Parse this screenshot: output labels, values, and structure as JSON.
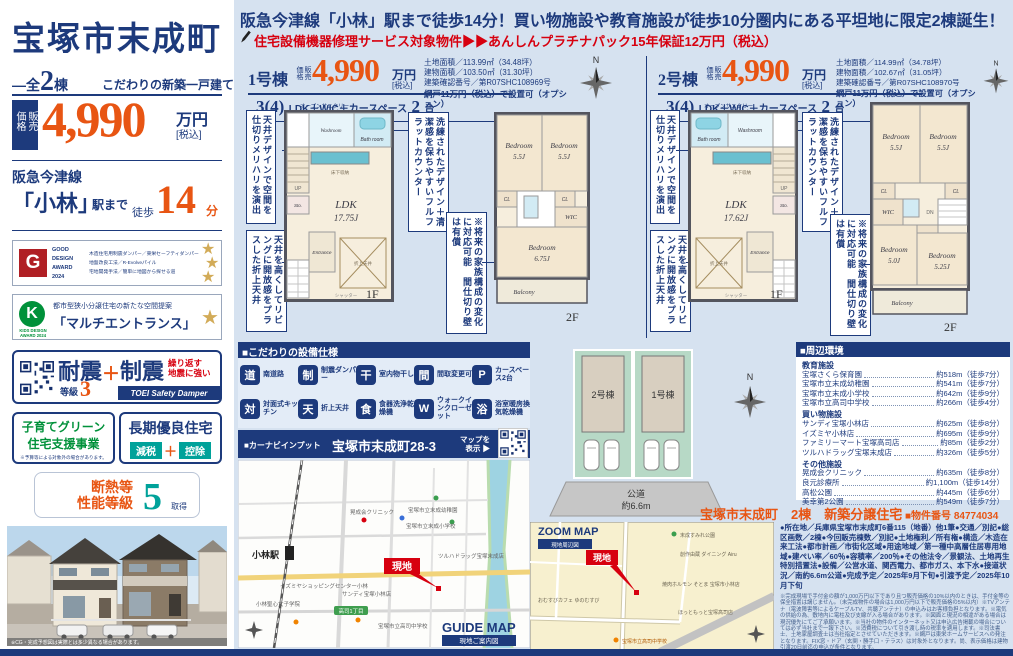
{
  "meta": {
    "compass_n": "N"
  },
  "sidebar": {
    "title": "宝塚市末成町",
    "units_dash": "—",
    "units_prefix": "全",
    "units_num": "2",
    "units_suffix": "棟",
    "tagline": "こだわりの新築一戸建て",
    "price_tag": "販売価格",
    "price": "4,990",
    "price_unit": "万円",
    "price_tax": "[税込]",
    "line_name": "阪急今津線",
    "station": "「小林」",
    "station_suffix": "駅まで",
    "walk_label": "徒歩",
    "walk_num": "14",
    "walk_unit": "分",
    "good_design": {
      "label1": "GOOD",
      "label2": "DESIGN",
      "label3": "AWARD",
      "label4": "2024",
      "desc1": "木造住宅用制震ダンパー／東栄セーフティダンパー",
      "desc2": "地盤改良工法／R-Evolveパイル",
      "desc3": "宅地開発手法／簡単に地図から探せる道"
    },
    "kids_design": {
      "label1": "KIDS DESIGN",
      "label2": "AWARD 2024",
      "desc": "都市型狭小分譲住宅の新たな空間提案",
      "name": "「マルチエントランス」"
    },
    "taishin": {
      "t1": "耐震",
      "grade_label": "等級",
      "grade_num": "3",
      "plus": "＋",
      "t2": "制震",
      "note1": "繰り返す",
      "note2": "地震に強い",
      "brand": "TOEI Safety Damper"
    },
    "kosodate": {
      "l1": "子育てグリーン",
      "l2": "住宅支援事業",
      "note": "※予算等による対象外の場合があります。"
    },
    "chouki": {
      "title": "長期優良住宅",
      "tag1": "減税",
      "plus": "＋",
      "tag2": "控除"
    },
    "dannetsu": {
      "l1": "断熱等",
      "l2": "性能等級",
      "num": "5",
      "suffix": "取得"
    },
    "photo_caption": "※CG・完成予想図は実際とは多少異なる場合があります。"
  },
  "banner": {
    "headline": "阪急今津線「小林」駅まで徒歩14分！買い物施設や教育施設が徒歩10分圏内にある平坦地に限定2棟誕生！",
    "subline": "住宅設備機器修理サービス対象物件▶▶あんしんプラチナパック15年保証12万円（税込）"
  },
  "units": [
    {
      "name": "1号棟",
      "price_tag": "販売価格",
      "price": "4,990",
      "unit": "万円",
      "tax": "[税込]",
      "lay_b1": "3(4)",
      "lay_s1": "LDK＋WIC＋カースペース",
      "lay_b2": "2",
      "lay_s2": "台",
      "specs": [
        "土地面積／113.99㎡（34.48坪）",
        "建物面積／103.50㎡（31.30坪）",
        "建築確認番号／第R07SHC108969号"
      ],
      "option": "網戸11万円（税込）で設置可（オプション）"
    },
    {
      "name": "2号棟",
      "price_tag": "販売価格",
      "price": "4,990",
      "unit": "万円",
      "tax": "[税込]",
      "lay_b1": "3(4)",
      "lay_s1": "LDK＋WIC＋カースペース",
      "lay_b2": "2",
      "lay_s2": "台",
      "specs": [
        "土地面積／114.99㎡（34.78坪）",
        "建物面積／102.67㎡（31.05坪）",
        "建築確認番号／第R07SHC108970号"
      ],
      "option": "網戸11万円（税込）で設置可（オプション）"
    }
  ],
  "callouts": {
    "c1": "天井デザインで空間を仕切りメリハリを演出",
    "c2": "天井を高くしてリビングに開放感をプラスした折上天井",
    "c3": "洗練されたデザイン＋清潔感を保ちやすいフルフラットカウンター",
    "c4": "※将来の家族構成の変化に対応可能　間仕切り壁は有償"
  },
  "plans": {
    "common": {
      "sanitary": "オープンサニタリー",
      "shutter": "シャッター",
      "up": "UP",
      "dn": "DN"
    },
    "u1f1": {
      "floor": "1F",
      "ldk": "LDK",
      "ldk_size": "17.75J",
      "bath": "Bath room",
      "wash": "Washroom",
      "entrance": "Entrance",
      "sto": "Sto.",
      "pantry": "床下収納",
      "ceiling": "折上天井"
    },
    "u1f2": {
      "floor": "2F",
      "bed1": "Bedroom",
      "bed1_s": "5.5J",
      "bed2": "Bedroom",
      "bed2_s": "5.5J",
      "bed3": "Bedroom",
      "bed3_s": "6.75J",
      "wic": "WIC",
      "cl": "CL",
      "balcony": "Balcony"
    },
    "u2f1": {
      "floor": "1F",
      "ldk": "LDK",
      "ldk_size": "17.62J",
      "bath": "Bath room",
      "wash": "Washroom",
      "entrance": "Entrance",
      "sto": "Sto.",
      "pantry": "床下収納",
      "ceiling": "折上天井"
    },
    "u2f2": {
      "floor": "2F",
      "bed1": "Bedroom",
      "bed1_s": "5.5J",
      "bed2": "Bedroom",
      "bed2_s": "5.5J",
      "bed3": "Bedroom",
      "bed3_s": "5.0J",
      "bed4": "Bedroom",
      "bed4_s": "5.25J",
      "wic": "WIC",
      "cl": "CL",
      "balcony": "Balcony"
    }
  },
  "equipment": {
    "title": "■こだわりの設備仕様",
    "items": [
      {
        "g": "道",
        "label": "南道路"
      },
      {
        "g": "制",
        "label": "制震ダンパー"
      },
      {
        "g": "干",
        "label": "室内物干し"
      },
      {
        "g": "間",
        "label": "間取変更可"
      },
      {
        "g": "P",
        "label": "カースペース2台"
      },
      {
        "g": "対",
        "label": "対面式キッチン"
      },
      {
        "g": "天",
        "label": "折上天井"
      },
      {
        "g": "食",
        "label": "食器洗浄乾燥機"
      },
      {
        "g": "W",
        "label": "ウォークインクローゼット"
      },
      {
        "g": "浴",
        "label": "浴室暖房換気乾燥機"
      }
    ]
  },
  "carnav": {
    "label": "■カーナビインプット",
    "address": "宝塚市末成町28-3",
    "map_btn1": "マップを",
    "map_btn2": "表示 ▶"
  },
  "guide_map": {
    "station": "小林駅",
    "flag": "現地",
    "road_badge": "高司1丁目",
    "title": "GUIDE MAP",
    "subtitle": "現地ご案内図",
    "labels": [
      "宝塚市立末成幼稚園",
      "宝塚市立末成小学校",
      "晃成会クリニック",
      "サンディ宝塚小林店",
      "イズミヤショッピングセンター小林",
      "ツルハドラッグ宝塚末成店",
      "宝塚市立高司中学校",
      "小林聖心女子学院"
    ]
  },
  "site_plan": {
    "lot_back": "2号棟",
    "lot_front": "1号棟",
    "road1": "公道",
    "road2": "約6.6m"
  },
  "environment": {
    "title": "■周辺環境",
    "groups": [
      {
        "name": "教育施設",
        "items": [
          {
            "name": "宝塚さくら保育園",
            "dist": "約518m（徒歩7分）"
          },
          {
            "name": "宝塚市立末成幼稚園",
            "dist": "約541m（徒歩7分）"
          },
          {
            "name": "宝塚市立末成小学校",
            "dist": "約642m（徒歩9分）"
          },
          {
            "name": "宝塚市立高司中学校",
            "dist": "約266m（徒歩4分）"
          }
        ]
      },
      {
        "name": "買い物施設",
        "items": [
          {
            "name": "サンディ宝塚小林店",
            "dist": "約625m（徒歩8分）"
          },
          {
            "name": "イズミヤ小林店",
            "dist": "約695m（徒歩9分）"
          },
          {
            "name": "ファミリーマート宝塚高司店",
            "dist": "約85m（徒歩2分）"
          },
          {
            "name": "ツルハドラッグ宝塚末成店",
            "dist": "約326m（徒歩5分）"
          }
        ]
      },
      {
        "name": "その他施設",
        "items": [
          {
            "name": "晃成会クリニック",
            "dist": "約635m（徒歩8分）"
          },
          {
            "name": "良元診療所",
            "dist": "約1,100m（徒歩14分）"
          },
          {
            "name": "高松公園",
            "dist": "約445m（徒歩6分）"
          },
          {
            "name": "美幸第2公園",
            "dist": "約549m（徒歩7分）"
          }
        ]
      }
    ]
  },
  "zoom_map": {
    "title": "ZOOM MAP",
    "tag": "現地周辺図",
    "flag": "現地",
    "labels": [
      "末成すみれ公園",
      "創作由蔵 ダイニング Airu",
      "焼肉ホルモン そとま 宝塚市小林店",
      "おむすびカフェ ゆのむすび",
      "ほっともっと宝塚高司店",
      "宝塚市立高司中学校"
    ]
  },
  "property": {
    "title": "宝塚市末成町　2棟　新築分譲住宅",
    "number": "■物件番号 84774034",
    "details": "●所在地／兵庫県宝塚市末成町6番115（地番）他1筆●交通／別記●総区画数／2棟●今回販売棟数／別記●土地権利／所有権●構造／木造在来工法●都市計画／市街化区域●用途地域／第一種中高層住居専用地域●建ぺい率／60％●容積率／200％●その他法令／景観法、土地再生特別措置法●設備／公営水道、関西電力、都市ガス、本下水●接道状況／南約6.6m公道●完成予定／2025年9月下旬●引渡予定／2025年10月下旬",
    "fine_print": "※完成現場で手付金の額が1,000万円以下であり且つ販売価格の10%以内のときは、手付金等の保全措置は講じません。（未完成物件の場合は1,000万円以下で販売価格の5%以内）※TVアンテナ（電波障害等によるケーブルTV、共聴アンテナ）の申込みはお客様負担となります。※電気の供給の為、敷地内に電柱及び支線が入る場合があります。※図面と現況の相違がある場合は現況優先にてご了承願います。※当社の物件のインターネット又は申込広告掲載の場合については必ず当社まで一報下さい。※消費税について引き渡し時の税率を適用します。※司法書士、土地家屋調査士は当社指定とさせていただきます。※網戸は東栄ホームサービスへの発注となります。FIX窓・ドア（玄関・勝手口・テラス）は対象外となります。尚、表示価格は建物引渡20日前迄の申込が条件となります。"
  }
}
